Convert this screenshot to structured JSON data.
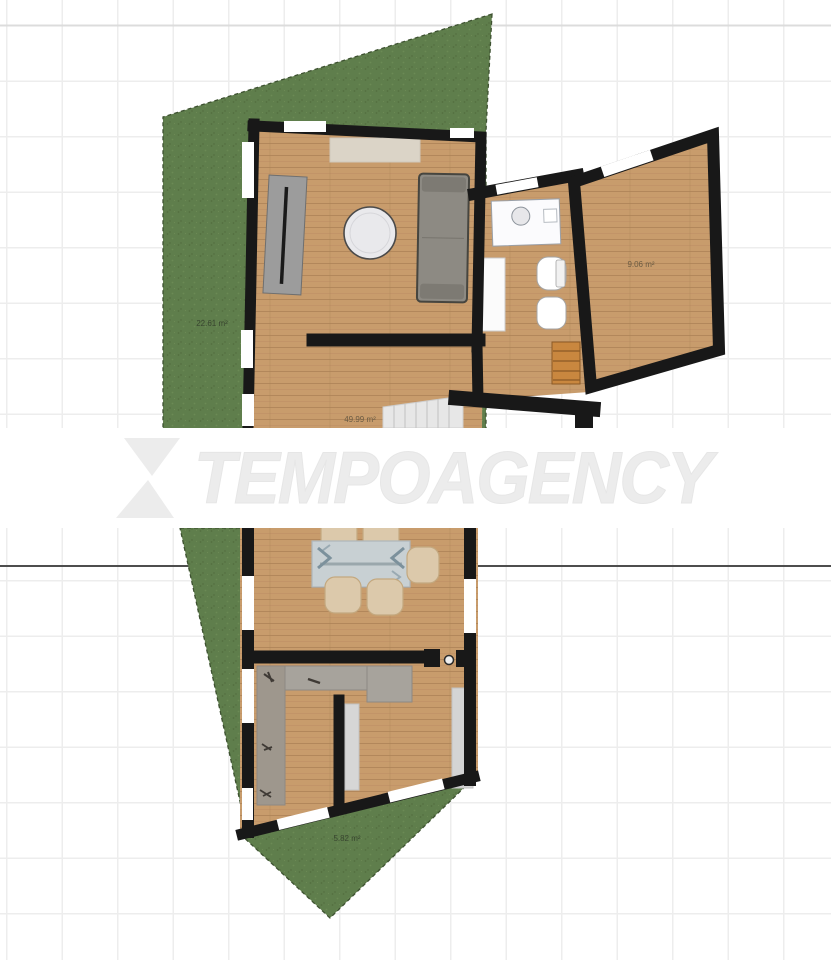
{
  "image": {
    "type": "floor-plan-screenshot"
  },
  "watermark": {
    "text": "TEMPOAGENCY",
    "logo": "hourglass-x-logo",
    "color": "#ececec"
  },
  "labels": {
    "garden_top_area": "22.61 m²",
    "side_room_area": "9.06 m²",
    "main_room_area": "49.99 m²",
    "garden_bottom_area": "5.82 m²"
  },
  "colors": {
    "grass": "#5f7e4c",
    "grass_border": "#3d5130",
    "wood_floor": "#c89c6c",
    "wall": "#181818",
    "grid": "#ededed",
    "section_line": "#4e4e4e",
    "watermark_gray": "#ececec"
  }
}
